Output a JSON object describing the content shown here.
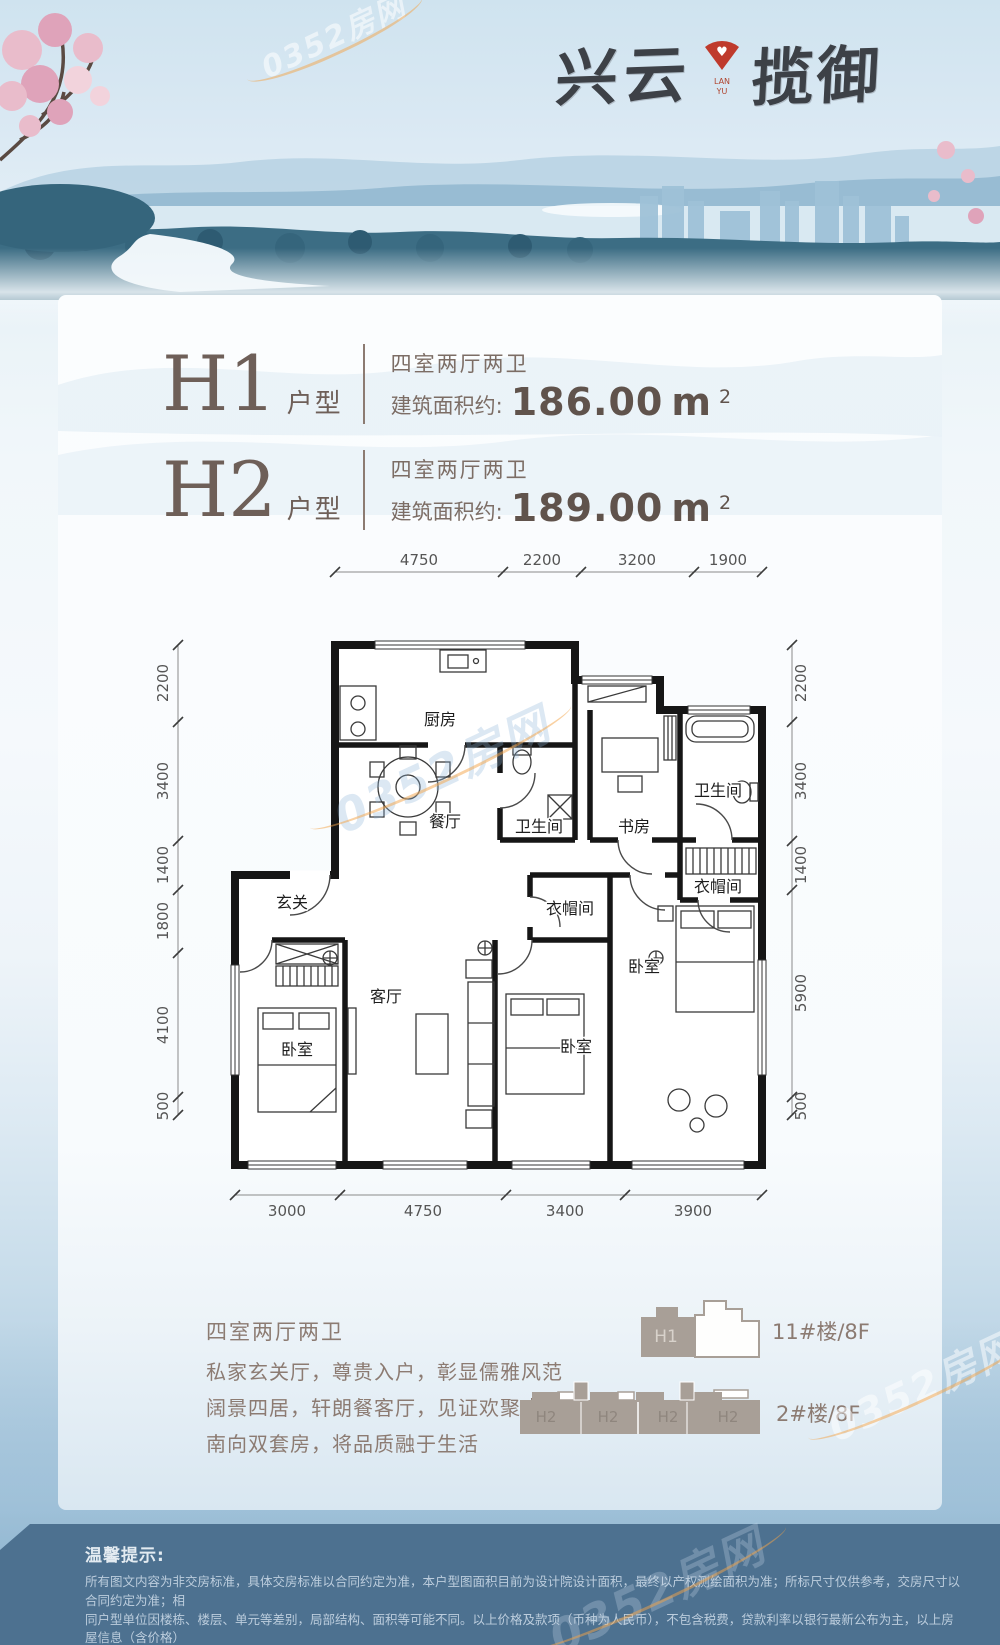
{
  "brand": {
    "name_left": "兴云",
    "name_right": "揽御",
    "emblem_line1": "LAN",
    "emblem_line2": "YU",
    "emblem_color": "#bf3a2c"
  },
  "watermark": {
    "text": "0352房网"
  },
  "units": [
    {
      "name": "H1",
      "suffix": "户型",
      "rooms": "四室两厅两卫",
      "area_label": "建筑面积约:",
      "area_value": "186.00",
      "area_unit": "m",
      "area_sup": "2"
    },
    {
      "name": "H2",
      "suffix": "户型",
      "rooms": "四室两厅两卫",
      "area_label": "建筑面积约:",
      "area_value": "189.00",
      "area_unit": "m",
      "area_sup": "2"
    }
  ],
  "floorplan": {
    "dims_top": [
      "4750",
      "2200",
      "3200",
      "1900"
    ],
    "dims_bottom": [
      "3000",
      "4750",
      "3400",
      "3900"
    ],
    "dims_left": [
      "2200",
      "3400",
      "1400",
      "1800",
      "4100",
      "500"
    ],
    "dims_right": [
      "2200",
      "3400",
      "1400",
      "5900",
      "500"
    ],
    "rooms": {
      "kitchen": "厨房",
      "dining": "餐厅",
      "bath_a": "卫生间",
      "study": "书房",
      "bath_b": "卫生间",
      "cloak_a": "衣帽间",
      "cloak_b": "衣帽间",
      "entry": "玄关",
      "living": "客厅",
      "bedroom_a": "卧室",
      "bedroom_b": "卧室",
      "bedroom_c": "卧室"
    }
  },
  "features": {
    "title": "四室两厅两卫",
    "lines": [
      "私家玄关厅，尊贵入户，彰显儒雅风范",
      "阔景四居，轩朗餐客厅，见证欢聚盛宴",
      "南向双套房，将品质融于生活"
    ]
  },
  "buildings": [
    {
      "unit": "H1",
      "label": "11#楼/8F"
    },
    {
      "units": [
        "H2",
        "H2",
        "H2",
        "H2"
      ],
      "label": "2#楼/8F"
    }
  ],
  "footer": {
    "title": "温馨提示:",
    "lines": [
      "所有图文内容为非交房标准，具体交房标准以合同约定为准，本户型图面积目前为设计院设计面积，最终以产权测绘面积为准；所标尺寸仅供参考，交房尺寸以合同约定为准；相",
      "同户型单位因楼栋、楼层、单元等差别，局部结构、面积等可能不同。以上价格及款项（币种为人民币），不包含税费，贷款利率以银行最新公布为主，以上房屋信息（含价格）",
      "仅供参考，本公司保留对价格进行调整的权利，具体房屋价格以双方签署的商品房买卖合同为准，如有变化，恕不另行通知。"
    ]
  }
}
